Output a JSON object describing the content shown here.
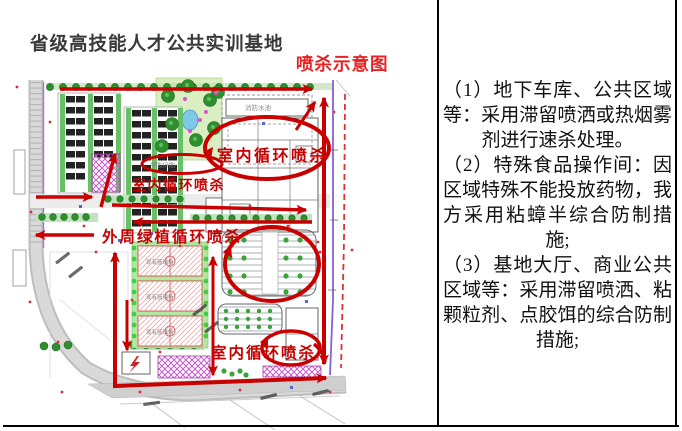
{
  "header": {
    "title": "省级高技能人才公共实训基地",
    "caption": "喷杀示意图"
  },
  "map": {
    "annotations": {
      "indoor_loop_top_right": "室内循环喷杀",
      "indoor_loop_center": "室内循环喷杀",
      "perimeter_green": "外周绿植循环喷杀",
      "indoor_loop_bottom": "室内循环喷杀"
    },
    "labels": {
      "fire_pool": "消防水池",
      "basketball_court": "现有篮球场",
      "old_hall": "场馆(旧馆)"
    }
  },
  "notes": {
    "lines": [
      {
        "text": "（1）地下车库、公共区域"
      },
      {
        "text": "等：采用滞留喷洒或热烟雾"
      },
      {
        "text": "剂进行速杀处理。"
      },
      {
        "text": "（2）特殊食品操作间：因"
      },
      {
        "text": "区域特殊不能投放药物，我"
      },
      {
        "text": "方采用粘蟑半综合防制措"
      },
      {
        "text": "施;"
      },
      {
        "text": "（3）基地大厅、商业公共"
      },
      {
        "text": "区域等：采用滞留喷洒、粘"
      },
      {
        "text": "颗粒剂、点胶饵的综合防制"
      },
      {
        "text": "措施;"
      }
    ]
  },
  "colors": {
    "annotation_red": "#c80000",
    "caption_red": "#e62222",
    "boundary_purple": "#8a5fd0",
    "boundary_dash_red": "#dd3333",
    "road_grey": "#cfcfcf",
    "garden_green": "#d9efc2"
  }
}
